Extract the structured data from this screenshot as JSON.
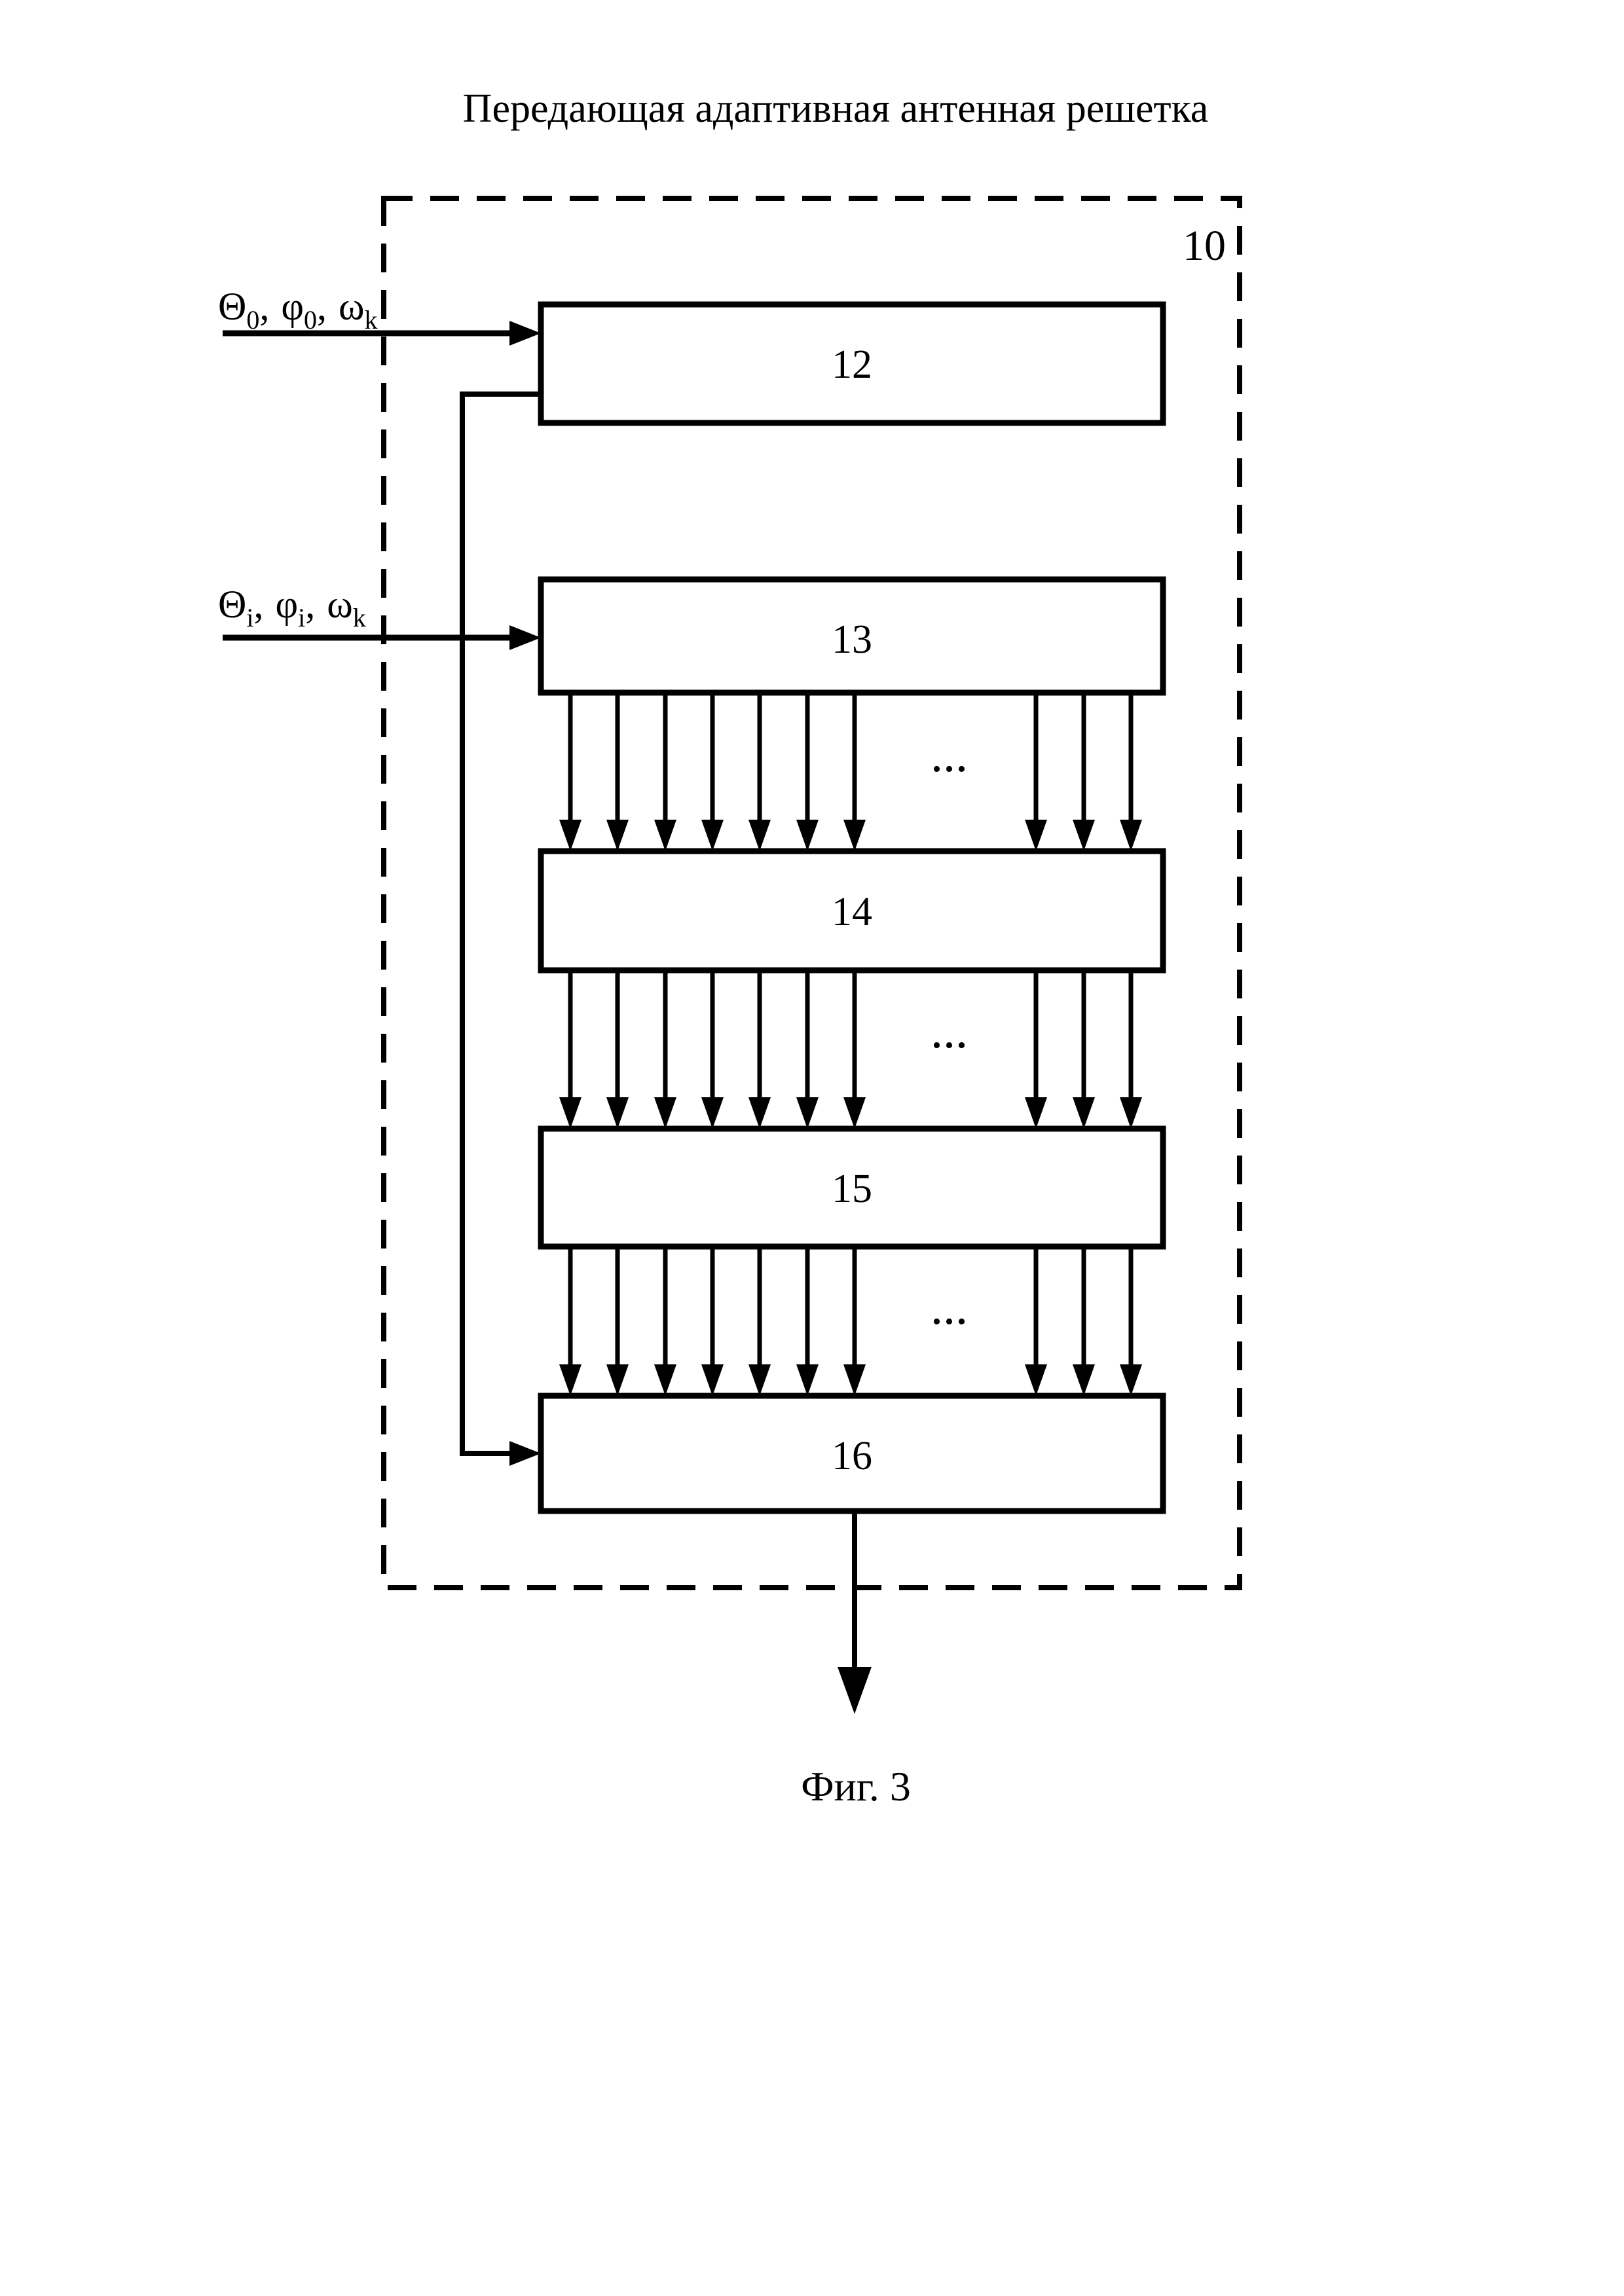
{
  "figure": {
    "title": "Передающая адаптивная антенная решетка",
    "caption": "Фиг. 3",
    "outer_block": {
      "label": "10"
    },
    "blocks": [
      {
        "id": "block-12",
        "label": "12"
      },
      {
        "id": "block-13",
        "label": "13"
      },
      {
        "id": "block-14",
        "label": "14"
      },
      {
        "id": "block-15",
        "label": "15"
      },
      {
        "id": "block-16",
        "label": "16"
      }
    ],
    "inputs": [
      {
        "name": "input-signal-0",
        "parts": [
          "Θ",
          "0",
          ",",
          "φ",
          "0",
          ",",
          "ω",
          "k"
        ]
      },
      {
        "name": "input-signal-i",
        "parts": [
          "Θ",
          "i",
          ",",
          "φ",
          "i",
          ",",
          "ω",
          "k"
        ]
      }
    ],
    "ellipsis": "...",
    "colors": {
      "ink": "#000000",
      "paper": "#ffffff"
    }
  }
}
